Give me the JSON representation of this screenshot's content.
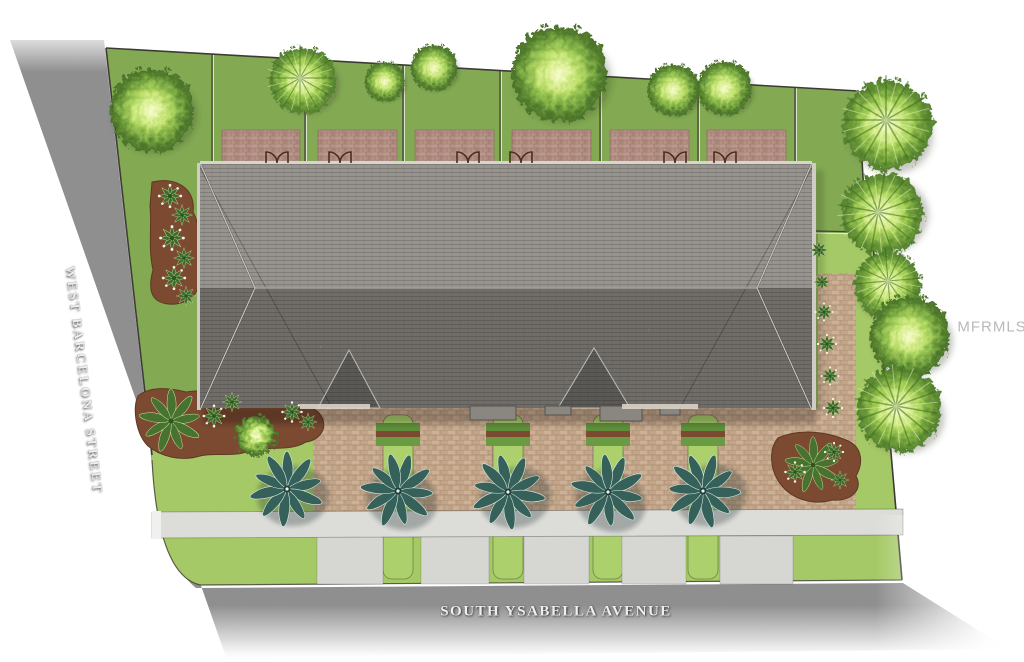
{
  "page": {
    "type": "architectural-site-plan-rendering",
    "background": "#ffffff"
  },
  "labels": {
    "west_street": "WEST BARCELONA STREET",
    "south_avenue": "SOUTH YSABELLA AVENUE",
    "watermark": "MFRMLS"
  },
  "scene": {
    "building": {
      "kind": "townhome-building-roof",
      "units": 6,
      "rear_patios": 6,
      "rear_patio_doors": 6
    },
    "landscaping": {
      "front_palms": 5,
      "driveway_grass_strips": 4,
      "rear_trees": 7,
      "east_trees": 5
    },
    "streets": {
      "west": "asphalt",
      "south": "asphalt",
      "sidewalk": "concrete"
    }
  },
  "palette": {
    "asphalt": "#8f8f8f",
    "sidewalk": "#dcdcd9",
    "lawn_back": "#83aa52",
    "lawn_front": "#a7cb67",
    "driveway_paver": "#c7aa8e",
    "patio_paver": "#b69186",
    "roof_light": "#97948f",
    "roof_dark": "#6f6d69",
    "mulch": "#7b4a31",
    "palm_teal": "#35615a",
    "tree_green": "#8cc63f",
    "street_text": "#efefec",
    "watermark_text": "#b9b9b9"
  }
}
